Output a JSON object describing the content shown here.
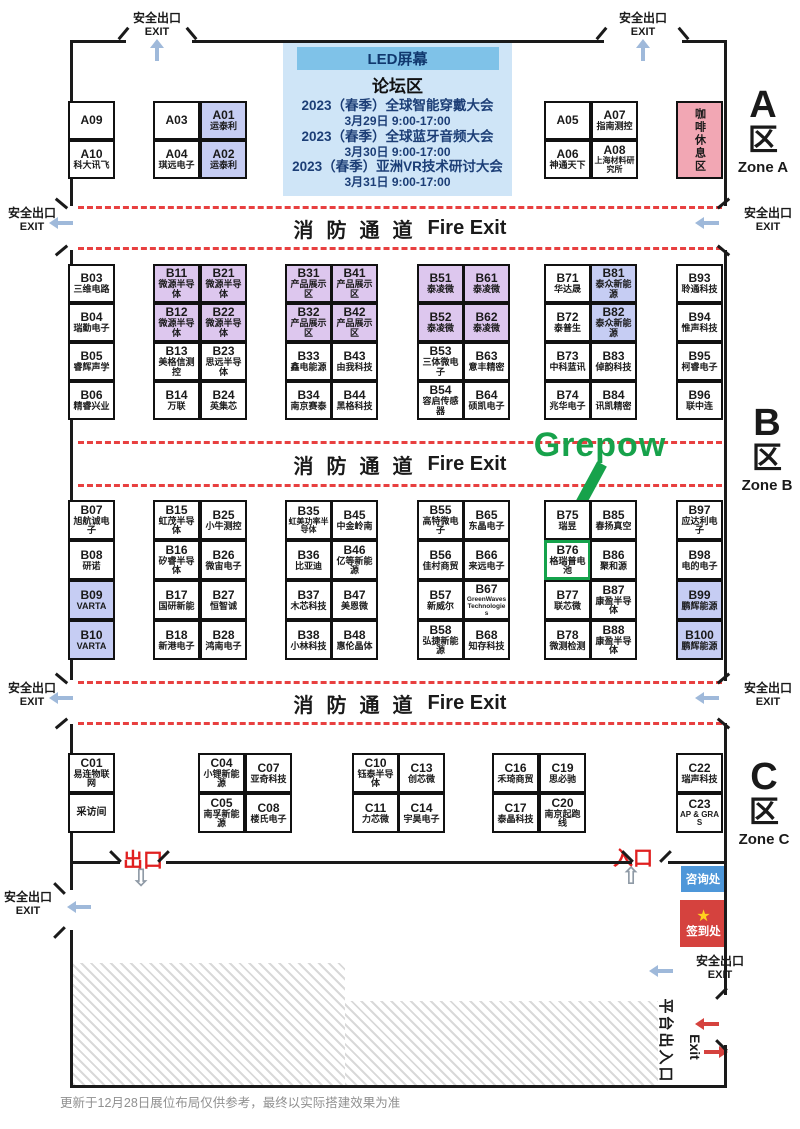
{
  "labels": {
    "fire_cn": "消防通道",
    "fire_en": "Fire Exit",
    "safety_exit_cn": "安全出口",
    "safety_exit_en": "EXIT",
    "exit_cn": "出口",
    "entrance_cn": "入口",
    "info_desk": "咨询处",
    "checkin": "签到处",
    "checkin_star": "★",
    "coffee": "咖啡休息区",
    "grepow": "Grepow",
    "platform_cn": "平台出入口",
    "platform_en": "Exit",
    "exit_down_arrow": "⇩",
    "entrance_up_arrow": "⇧",
    "footer": "更新于12月28日展位布局仅供参考，最终以实际搭建效果为准"
  },
  "forum": {
    "led": "LED屏幕",
    "title": "论坛区",
    "events": [
      {
        "name": "2023（春季）全球智能穿戴大会",
        "time": "3月29日 9:00-17:00"
      },
      {
        "name": "2023（春季）全球蓝牙音频大会",
        "time": "3月30日 9:00-17:00"
      },
      {
        "name": "2023（春季）亚洲VR技术研讨大会",
        "time": "3月31日 9:00-17:00"
      }
    ]
  },
  "zone_labels": [
    {
      "letter": "A",
      "cn": "区",
      "en": "Zone A"
    },
    {
      "letter": "B",
      "cn": "区",
      "en": "Zone B"
    },
    {
      "letter": "C",
      "cn": "区",
      "en": "Zone C"
    }
  ],
  "colors": {
    "booth_purple": "#ddc7ee",
    "booth_blue": "#c6cdf3",
    "coffee_pink": "#f2a7b4",
    "lane_red": "#e84040",
    "grepow_green": "#17a24b",
    "info_blue": "#4e97d9",
    "checkin_red": "#d5423e",
    "star_yellow": "#ffd21e",
    "forum_bg": "#cfe5f7",
    "forum_header": "#7fc2e8",
    "wall": "#1a1a1a",
    "exit_arrow_blue": "#9fb9da",
    "red_door_text": "#e02020"
  },
  "booths": [
    {
      "id": "A09",
      "name": "",
      "x": 68,
      "y": 101,
      "w": 47,
      "h": 39
    },
    {
      "id": "A10",
      "name": "科大讯飞",
      "x": 68,
      "y": 140,
      "w": 47,
      "h": 39
    },
    {
      "id": "A03",
      "name": "",
      "x": 153,
      "y": 101,
      "w": 47,
      "h": 39
    },
    {
      "id": "A04",
      "name": "琪远电子",
      "x": 153,
      "y": 140,
      "w": 47,
      "h": 39
    },
    {
      "id": "A01",
      "name": "运泰利",
      "x": 200,
      "y": 101,
      "w": 47,
      "h": 39,
      "c": "blue"
    },
    {
      "id": "A02",
      "name": "运泰利",
      "x": 200,
      "y": 140,
      "w": 47,
      "h": 39,
      "c": "blue"
    },
    {
      "id": "A05",
      "name": "",
      "x": 544,
      "y": 101,
      "w": 47,
      "h": 39
    },
    {
      "id": "A06",
      "name": "神通天下",
      "x": 544,
      "y": 140,
      "w": 47,
      "h": 39
    },
    {
      "id": "A07",
      "name": "指南测控",
      "x": 591,
      "y": 101,
      "w": 47,
      "h": 39
    },
    {
      "id": "A08",
      "name": "上海材料研究所",
      "x": 591,
      "y": 140,
      "w": 47,
      "h": 39,
      "fs": 8
    },
    {
      "id": "B03",
      "name": "三维电路",
      "x": 68,
      "y": 264,
      "w": 47,
      "h": 39
    },
    {
      "id": "B04",
      "name": "瑞勤电子",
      "x": 68,
      "y": 303,
      "w": 47,
      "h": 39
    },
    {
      "id": "B05",
      "name": "睿辉声学",
      "x": 68,
      "y": 342,
      "w": 47,
      "h": 39
    },
    {
      "id": "B06",
      "name": "精睿兴业",
      "x": 68,
      "y": 381,
      "w": 47,
      "h": 39
    },
    {
      "id": "B11",
      "name": "微源半导体",
      "x": 153,
      "y": 264,
      "w": 47,
      "h": 39,
      "c": "purple"
    },
    {
      "id": "B12",
      "name": "微源半导体",
      "x": 153,
      "y": 303,
      "w": 47,
      "h": 39,
      "c": "purple"
    },
    {
      "id": "B13",
      "name": "美格信测控",
      "x": 153,
      "y": 342,
      "w": 47,
      "h": 39
    },
    {
      "id": "B14",
      "name": "万联",
      "x": 153,
      "y": 381,
      "w": 47,
      "h": 39
    },
    {
      "id": "B21",
      "name": "微源半导体",
      "x": 200,
      "y": 264,
      "w": 47,
      "h": 39,
      "c": "purple"
    },
    {
      "id": "B22",
      "name": "微源半导体",
      "x": 200,
      "y": 303,
      "w": 47,
      "h": 39,
      "c": "purple"
    },
    {
      "id": "B23",
      "name": "思远半导体",
      "x": 200,
      "y": 342,
      "w": 47,
      "h": 39
    },
    {
      "id": "B24",
      "name": "英集芯",
      "x": 200,
      "y": 381,
      "w": 47,
      "h": 39
    },
    {
      "id": "B31",
      "name": "产品展示区",
      "x": 285,
      "y": 264,
      "w": 47,
      "h": 39,
      "c": "purple"
    },
    {
      "id": "B32",
      "name": "产品展示区",
      "x": 285,
      "y": 303,
      "w": 47,
      "h": 39,
      "c": "purple"
    },
    {
      "id": "B33",
      "name": "鑫电能源",
      "x": 285,
      "y": 342,
      "w": 47,
      "h": 39
    },
    {
      "id": "B34",
      "name": "南京赛泰",
      "x": 285,
      "y": 381,
      "w": 47,
      "h": 39
    },
    {
      "id": "B41",
      "name": "产品展示区",
      "x": 331,
      "y": 264,
      "w": 47,
      "h": 39,
      "c": "purple"
    },
    {
      "id": "B42",
      "name": "产品展示区",
      "x": 331,
      "y": 303,
      "w": 47,
      "h": 39,
      "c": "purple"
    },
    {
      "id": "B43",
      "name": "由我科技",
      "x": 331,
      "y": 342,
      "w": 47,
      "h": 39
    },
    {
      "id": "B44",
      "name": "黑格科技",
      "x": 331,
      "y": 381,
      "w": 47,
      "h": 39
    },
    {
      "id": "B51",
      "name": "泰凌微",
      "x": 417,
      "y": 264,
      "w": 47,
      "h": 39,
      "c": "purple"
    },
    {
      "id": "B52",
      "name": "泰凌微",
      "x": 417,
      "y": 303,
      "w": 47,
      "h": 39,
      "c": "purple"
    },
    {
      "id": "B53",
      "name": "三体微电子",
      "x": 417,
      "y": 342,
      "w": 47,
      "h": 39
    },
    {
      "id": "B54",
      "name": "容启传感器",
      "x": 417,
      "y": 381,
      "w": 47,
      "h": 39
    },
    {
      "id": "B61",
      "name": "泰凌微",
      "x": 463,
      "y": 264,
      "w": 47,
      "h": 39,
      "c": "purple"
    },
    {
      "id": "B62",
      "name": "泰凌微",
      "x": 463,
      "y": 303,
      "w": 47,
      "h": 39,
      "c": "purple"
    },
    {
      "id": "B63",
      "name": "意丰精密",
      "x": 463,
      "y": 342,
      "w": 47,
      "h": 39
    },
    {
      "id": "B64",
      "name": "硕凯电子",
      "x": 463,
      "y": 381,
      "w": 47,
      "h": 39
    },
    {
      "id": "B71",
      "name": "华达晟",
      "x": 544,
      "y": 264,
      "w": 47,
      "h": 39
    },
    {
      "id": "B72",
      "name": "泰普生",
      "x": 544,
      "y": 303,
      "w": 47,
      "h": 39
    },
    {
      "id": "B73",
      "name": "中科蓝讯",
      "x": 544,
      "y": 342,
      "w": 47,
      "h": 39
    },
    {
      "id": "B74",
      "name": "兆华电子",
      "x": 544,
      "y": 381,
      "w": 47,
      "h": 39
    },
    {
      "id": "B81",
      "name": "泰众新能源",
      "x": 590,
      "y": 264,
      "w": 47,
      "h": 39,
      "c": "blue"
    },
    {
      "id": "B82",
      "name": "泰众新能源",
      "x": 590,
      "y": 303,
      "w": 47,
      "h": 39,
      "c": "blue"
    },
    {
      "id": "B83",
      "name": "倬韵科技",
      "x": 590,
      "y": 342,
      "w": 47,
      "h": 39
    },
    {
      "id": "B84",
      "name": "讯凯精密",
      "x": 590,
      "y": 381,
      "w": 47,
      "h": 39
    },
    {
      "id": "B93",
      "name": "聆通科技",
      "x": 676,
      "y": 264,
      "w": 47,
      "h": 39
    },
    {
      "id": "B94",
      "name": "惟声科技",
      "x": 676,
      "y": 303,
      "w": 47,
      "h": 39
    },
    {
      "id": "B95",
      "name": "柯睿电子",
      "x": 676,
      "y": 342,
      "w": 47,
      "h": 39
    },
    {
      "id": "B96",
      "name": "联中连",
      "x": 676,
      "y": 381,
      "w": 47,
      "h": 39
    },
    {
      "id": "B07",
      "name": "旭航诚电子",
      "x": 68,
      "y": 500,
      "w": 47,
      "h": 40
    },
    {
      "id": "B08",
      "name": "研诺",
      "x": 68,
      "y": 540,
      "w": 47,
      "h": 40
    },
    {
      "id": "B09",
      "name": "VARTA",
      "x": 68,
      "y": 580,
      "w": 47,
      "h": 40,
      "c": "blue"
    },
    {
      "id": "B10",
      "name": "VARTA",
      "x": 68,
      "y": 620,
      "w": 47,
      "h": 40,
      "c": "blue"
    },
    {
      "id": "B15",
      "name": "虹茂半导体",
      "x": 153,
      "y": 500,
      "w": 47,
      "h": 40
    },
    {
      "id": "B16",
      "name": "矽睿半导体",
      "x": 153,
      "y": 540,
      "w": 47,
      "h": 40
    },
    {
      "id": "B17",
      "name": "国研新能",
      "x": 153,
      "y": 580,
      "w": 47,
      "h": 40
    },
    {
      "id": "B18",
      "name": "新港电子",
      "x": 153,
      "y": 620,
      "w": 47,
      "h": 40
    },
    {
      "id": "B25",
      "name": "小牛测控",
      "x": 200,
      "y": 500,
      "w": 47,
      "h": 40
    },
    {
      "id": "B26",
      "name": "微宙电子",
      "x": 200,
      "y": 540,
      "w": 47,
      "h": 40
    },
    {
      "id": "B27",
      "name": "恒智诚",
      "x": 200,
      "y": 580,
      "w": 47,
      "h": 40
    },
    {
      "id": "B28",
      "name": "鸿南电子",
      "x": 200,
      "y": 620,
      "w": 47,
      "h": 40
    },
    {
      "id": "B35",
      "name": "虹美功率半导体",
      "x": 285,
      "y": 500,
      "w": 47,
      "h": 40,
      "fs": 8
    },
    {
      "id": "B36",
      "name": "比亚迪",
      "x": 285,
      "y": 540,
      "w": 47,
      "h": 40
    },
    {
      "id": "B37",
      "name": "木芯科技",
      "x": 285,
      "y": 580,
      "w": 47,
      "h": 40
    },
    {
      "id": "B38",
      "name": "小林科技",
      "x": 285,
      "y": 620,
      "w": 47,
      "h": 40
    },
    {
      "id": "B45",
      "name": "中金岭南",
      "x": 331,
      "y": 500,
      "w": 47,
      "h": 40
    },
    {
      "id": "B46",
      "name": "亿等新能源",
      "x": 331,
      "y": 540,
      "w": 47,
      "h": 40
    },
    {
      "id": "B47",
      "name": "美恩微",
      "x": 331,
      "y": 580,
      "w": 47,
      "h": 40
    },
    {
      "id": "B48",
      "name": "惠伦晶体",
      "x": 331,
      "y": 620,
      "w": 47,
      "h": 40
    },
    {
      "id": "B55",
      "name": "高特微电子",
      "x": 417,
      "y": 500,
      "w": 47,
      "h": 40
    },
    {
      "id": "B56",
      "name": "佳村商贸",
      "x": 417,
      "y": 540,
      "w": 47,
      "h": 40
    },
    {
      "id": "B57",
      "name": "新威尔",
      "x": 417,
      "y": 580,
      "w": 47,
      "h": 40
    },
    {
      "id": "B58",
      "name": "弘捷新能源",
      "x": 417,
      "y": 620,
      "w": 47,
      "h": 40
    },
    {
      "id": "B65",
      "name": "东晶电子",
      "x": 463,
      "y": 500,
      "w": 47,
      "h": 40
    },
    {
      "id": "B66",
      "name": "来远电子",
      "x": 463,
      "y": 540,
      "w": 47,
      "h": 40
    },
    {
      "id": "B67",
      "name": "GreenWaves Technologies",
      "x": 463,
      "y": 580,
      "w": 47,
      "h": 40,
      "fs": 6.5
    },
    {
      "id": "B68",
      "name": "知存科技",
      "x": 463,
      "y": 620,
      "w": 47,
      "h": 40
    },
    {
      "id": "B75",
      "name": "瑞昱",
      "x": 544,
      "y": 500,
      "w": 47,
      "h": 40
    },
    {
      "id": "B76",
      "name": "格瑞普电池",
      "x": 544,
      "y": 540,
      "w": 47,
      "h": 40,
      "hl": true
    },
    {
      "id": "B77",
      "name": "联芯微",
      "x": 544,
      "y": 580,
      "w": 47,
      "h": 40
    },
    {
      "id": "B78",
      "name": "微测检测",
      "x": 544,
      "y": 620,
      "w": 47,
      "h": 40
    },
    {
      "id": "B85",
      "name": "春扬真空",
      "x": 590,
      "y": 500,
      "w": 47,
      "h": 40
    },
    {
      "id": "B86",
      "name": "聚和源",
      "x": 590,
      "y": 540,
      "w": 47,
      "h": 40
    },
    {
      "id": "B87",
      "name": "康盈半导体",
      "x": 590,
      "y": 580,
      "w": 47,
      "h": 40
    },
    {
      "id": "B88",
      "name": "康盈半导体",
      "x": 590,
      "y": 620,
      "w": 47,
      "h": 40
    },
    {
      "id": "B97",
      "name": "应达利电子",
      "x": 676,
      "y": 500,
      "w": 47,
      "h": 40
    },
    {
      "id": "B98",
      "name": "电的电子",
      "x": 676,
      "y": 540,
      "w": 47,
      "h": 40
    },
    {
      "id": "B99",
      "name": "鹏辉能源",
      "x": 676,
      "y": 580,
      "w": 47,
      "h": 40,
      "c": "blue"
    },
    {
      "id": "B100",
      "name": "鹏辉能源",
      "x": 676,
      "y": 620,
      "w": 47,
      "h": 40,
      "c": "blue"
    },
    {
      "id": "C01",
      "name": "易连物联网",
      "x": 68,
      "y": 753,
      "w": 47,
      "h": 40
    },
    {
      "id": "",
      "name": "采访间",
      "x": 68,
      "y": 793,
      "w": 47,
      "h": 40,
      "fs": 10
    },
    {
      "id": "C04",
      "name": "小锂新能源",
      "x": 198,
      "y": 753,
      "w": 47,
      "h": 40
    },
    {
      "id": "C05",
      "name": "南孚新能源",
      "x": 198,
      "y": 793,
      "w": 47,
      "h": 40
    },
    {
      "id": "C07",
      "name": "亚奇科技",
      "x": 245,
      "y": 753,
      "w": 47,
      "h": 40
    },
    {
      "id": "C08",
      "name": "楼氏电子",
      "x": 245,
      "y": 793,
      "w": 47,
      "h": 40
    },
    {
      "id": "C10",
      "name": "钰泰半导体",
      "x": 352,
      "y": 753,
      "w": 47,
      "h": 40
    },
    {
      "id": "C11",
      "name": "力芯微",
      "x": 352,
      "y": 793,
      "w": 47,
      "h": 40
    },
    {
      "id": "C13",
      "name": "创芯微",
      "x": 398,
      "y": 753,
      "w": 47,
      "h": 40
    },
    {
      "id": "C14",
      "name": "宇昊电子",
      "x": 398,
      "y": 793,
      "w": 47,
      "h": 40
    },
    {
      "id": "C16",
      "name": "禾琦商贸",
      "x": 492,
      "y": 753,
      "w": 47,
      "h": 40
    },
    {
      "id": "C17",
      "name": "泰晶科技",
      "x": 492,
      "y": 793,
      "w": 47,
      "h": 40
    },
    {
      "id": "C19",
      "name": "思必驰",
      "x": 539,
      "y": 753,
      "w": 47,
      "h": 40
    },
    {
      "id": "C20",
      "name": "南京起跑线",
      "x": 539,
      "y": 793,
      "w": 47,
      "h": 40
    },
    {
      "id": "C22",
      "name": "瑞声科技",
      "x": 676,
      "y": 753,
      "w": 47,
      "h": 40
    },
    {
      "id": "C23",
      "name": "AP & GRAS",
      "x": 676,
      "y": 793,
      "w": 47,
      "h": 40,
      "fs": 8
    }
  ],
  "walls": [
    [
      70,
      40,
      56,
      3
    ],
    [
      192,
      40,
      412,
      3
    ],
    [
      682,
      40,
      45,
      3
    ],
    [
      70,
      40,
      3,
      166
    ],
    [
      70,
      250,
      3,
      430
    ],
    [
      70,
      724,
      3,
      166
    ],
    [
      70,
      930,
      3,
      155
    ],
    [
      724,
      40,
      3,
      166
    ],
    [
      724,
      250,
      3,
      431
    ],
    [
      724,
      723,
      3,
      272
    ],
    [
      724,
      1045,
      3,
      43
    ],
    [
      70,
      1085,
      657,
      3
    ],
    [
      72,
      861,
      48,
      3
    ],
    [
      166,
      861,
      466,
      3
    ],
    [
      668,
      861,
      59,
      3
    ]
  ],
  "ticks": [
    [
      122,
      26,
      40
    ],
    [
      190,
      26,
      -40
    ],
    [
      600,
      26,
      40
    ],
    [
      682,
      26,
      -40
    ],
    [
      60,
      196,
      -50
    ],
    [
      60,
      243,
      50
    ],
    [
      722,
      196,
      50
    ],
    [
      722,
      243,
      -50
    ],
    [
      60,
      671,
      -50
    ],
    [
      60,
      716,
      50
    ],
    [
      722,
      671,
      50
    ],
    [
      722,
      716,
      -50
    ],
    [
      114,
      849,
      -45
    ],
    [
      162,
      849,
      45
    ],
    [
      626,
      849,
      -45
    ],
    [
      664,
      849,
      45
    ],
    [
      58,
      881,
      -45
    ],
    [
      58,
      925,
      45
    ],
    [
      720,
      986,
      45
    ],
    [
      720,
      1038,
      -45
    ]
  ],
  "exit_signs": [
    {
      "x": 129,
      "y": 12,
      "dir": "up",
      "ax": 155,
      "ay": 48
    },
    {
      "x": 615,
      "y": 12,
      "dir": "up",
      "ax": 641,
      "ay": 48
    },
    {
      "x": 4,
      "y": 207,
      "dir": "left",
      "ax": 58,
      "ay": 221
    },
    {
      "x": 740,
      "y": 207,
      "dir": "left",
      "ax": 704,
      "ay": 221
    },
    {
      "x": 4,
      "y": 682,
      "dir": "left",
      "ax": 58,
      "ay": 696
    },
    {
      "x": 740,
      "y": 682,
      "dir": "left",
      "ax": 704,
      "ay": 696
    },
    {
      "x": 0,
      "y": 891,
      "dir": "left",
      "ax": 76,
      "ay": 905
    },
    {
      "x": 692,
      "y": 955,
      "dir": "left",
      "ax": 658,
      "ay": 969
    }
  ]
}
